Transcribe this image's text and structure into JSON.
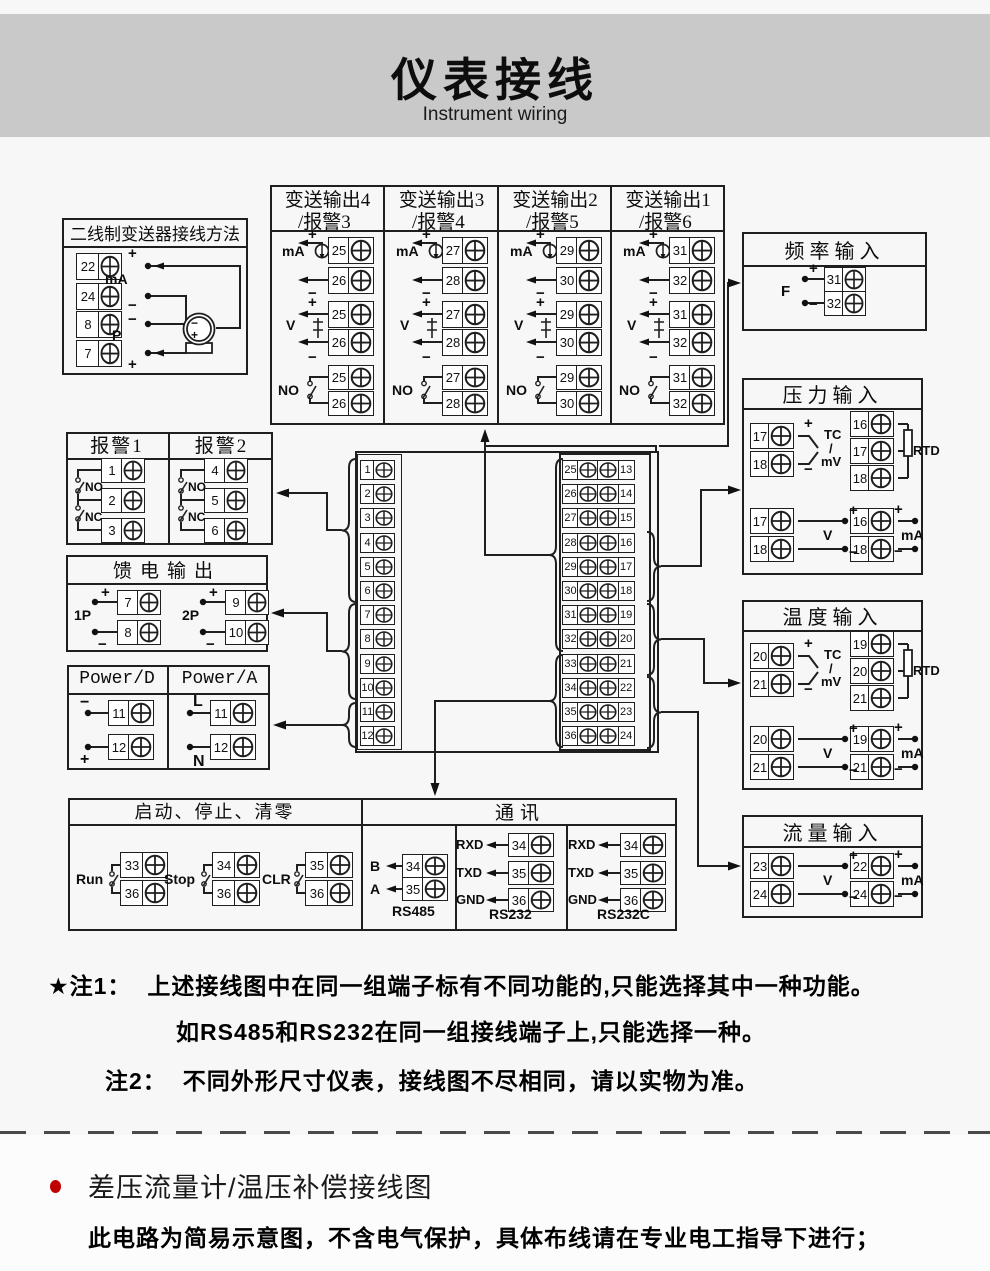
{
  "header": {
    "title": "仪表接线",
    "subtitle": "Instrument wiring"
  },
  "glyphs": {
    "plus": "+",
    "minus": "−"
  },
  "two_wire": {
    "title": "二线制变送器接线方法",
    "terminals": [
      "22",
      "24",
      "8",
      "7"
    ],
    "row_signs": [
      "+",
      "−",
      "−",
      "+"
    ],
    "mid_label_1": "mA",
    "mid_label_2": "P",
    "device_sign_top": "−",
    "device_sign_bottom": "+"
  },
  "transmit": {
    "columns": [
      {
        "title1": "变送输出4",
        "title2": "/报警3",
        "t1": "25",
        "t2": "26"
      },
      {
        "title1": "变送输出3",
        "title2": "/报警4",
        "t1": "27",
        "t2": "28"
      },
      {
        "title1": "变送输出2",
        "title2": "/报警5",
        "t1": "29",
        "t2": "30"
      },
      {
        "title1": "变送输出1",
        "title2": "/报警6",
        "t1": "31",
        "t2": "32"
      }
    ],
    "label_ma": "mA",
    "label_v": "V",
    "label_no": "NO"
  },
  "freq": {
    "title": "频率输入",
    "label": "F",
    "t1": "31",
    "t2": "32"
  },
  "pressure": {
    "title": "压力输入",
    "tc": {
      "t1": "17",
      "t2": "18",
      "l1": "TC",
      "l2": "/",
      "l3": "mV"
    },
    "rtd": {
      "t1": "16",
      "t2": "17",
      "t3": "18",
      "label": "RTD"
    },
    "v": {
      "t1": "17",
      "t2": "18",
      "label": "V"
    },
    "ma": {
      "t1": "16",
      "t2": "18",
      "label": "mA"
    }
  },
  "temperature": {
    "title": "温度输入",
    "tc": {
      "t1": "20",
      "t2": "21",
      "l1": "TC",
      "l2": "/",
      "l3": "mV"
    },
    "rtd": {
      "t1": "19",
      "t2": "20",
      "t3": "21",
      "label": "RTD"
    },
    "v": {
      "t1": "20",
      "t2": "21",
      "label": "V"
    },
    "ma": {
      "t1": "19",
      "t2": "21",
      "label": "mA"
    }
  },
  "flow": {
    "title": "流量输入",
    "v": {
      "t1": "23",
      "t2": "24",
      "label": "V"
    },
    "ma": {
      "t1": "22",
      "t2": "24",
      "label": "mA"
    }
  },
  "alarm": {
    "col1": {
      "title": "报警1",
      "t": [
        "1",
        "2",
        "3"
      ]
    },
    "col2": {
      "title": "报警2",
      "t": [
        "4",
        "5",
        "6"
      ]
    },
    "label_no": "NO",
    "label_nc": "NC"
  },
  "feed": {
    "title": "馈电输出",
    "g1": {
      "label": "1P",
      "t1": "7",
      "t2": "8"
    },
    "g2": {
      "label": "2P",
      "t1": "9",
      "t2": "10"
    }
  },
  "power": {
    "col1": {
      "title": "Power/D",
      "s1": "−",
      "t1": "11",
      "s2": "+",
      "t2": "12"
    },
    "col2": {
      "title": "Power/A",
      "s1": "L",
      "t1": "11",
      "s2": "N",
      "t2": "12"
    }
  },
  "runstop": {
    "title": "启动、停止、清零",
    "groups": [
      {
        "label": "Run",
        "t1": "33",
        "t2": "36"
      },
      {
        "label": "Stop",
        "t1": "34",
        "t2": "36"
      },
      {
        "label": "CLR",
        "t1": "35",
        "t2": "36"
      }
    ]
  },
  "comm": {
    "title": "通讯",
    "rs485": {
      "name": "RS485",
      "rows": [
        {
          "l": "B",
          "t": "34"
        },
        {
          "l": "A",
          "t": "35"
        }
      ]
    },
    "rs232": {
      "name": "RS232",
      "rows": [
        {
          "l": "RXD",
          "t": "34"
        },
        {
          "l": "TXD",
          "t": "35"
        },
        {
          "l": "GND",
          "t": "36"
        }
      ]
    },
    "rs232c": {
      "name": "RS232C",
      "rows": [
        {
          "l": "RXD",
          "t": "34"
        },
        {
          "l": "TXD",
          "t": "35"
        },
        {
          "l": "GND",
          "t": "36"
        }
      ]
    }
  },
  "center": {
    "left": [
      "1",
      "2",
      "3",
      "4",
      "5",
      "6",
      "7",
      "8",
      "9",
      "10",
      "11",
      "12"
    ],
    "right_a": [
      "25",
      "26",
      "27",
      "28",
      "29",
      "30",
      "31",
      "32",
      "33",
      "34",
      "35",
      "36"
    ],
    "right_b": [
      "13",
      "14",
      "15",
      "16",
      "17",
      "18",
      "19",
      "20",
      "21",
      "22",
      "23",
      "24"
    ]
  },
  "notes": {
    "n1_label": "★注1：",
    "n1_line1": "上述接线图中在同一组端子标有不同功能的,只能选择其中一种功能。",
    "n1_line2": "如RS485和RS232在同一组接线端子上,只能选择一种。",
    "n2_label": "注2：",
    "n2_text": "不同外形尺寸仪表，接线图不尽相同，请以实物为准。"
  },
  "footer": {
    "heading": "差压流量计/温压补偿接线图",
    "body": "此电路为简易示意图，不含电气保护，具体布线请在专业电工指导下进行；",
    "bullet_color": "#c00000"
  },
  "colors": {
    "line": "#1f1f1f",
    "header_bg": "#c9c9c9",
    "page_bg": "#f7f7f7"
  }
}
